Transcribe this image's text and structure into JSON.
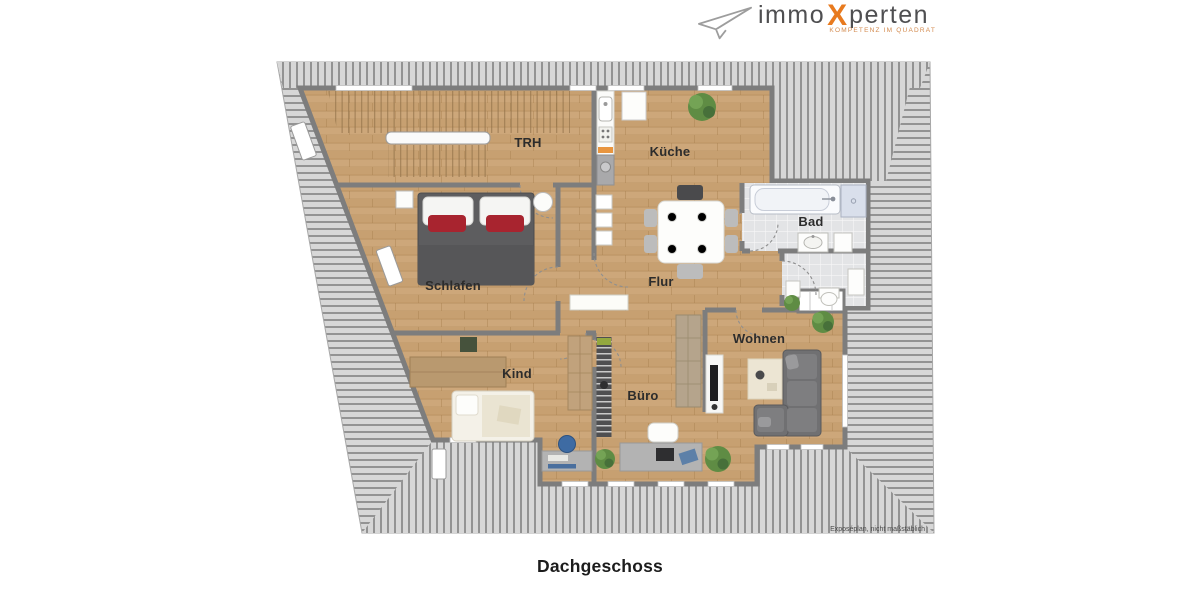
{
  "logo": {
    "brand_prefix": "immo",
    "brand_x": "X",
    "brand_suffix": "perten",
    "tagline": "KOMPETENZ IM QUADRAT"
  },
  "plan": {
    "title": "Dachgeschoss",
    "disclaimer": "Exposéplan, nicht maßstäblich",
    "rooms": [
      {
        "id": "trh",
        "label": "TRH"
      },
      {
        "id": "kueche",
        "label": "Küche"
      },
      {
        "id": "bad",
        "label": "Bad"
      },
      {
        "id": "schlafen",
        "label": "Schlafen"
      },
      {
        "id": "flur",
        "label": "Flur"
      },
      {
        "id": "kind",
        "label": "Kind"
      },
      {
        "id": "buero",
        "label": "Büro"
      },
      {
        "id": "wohnen",
        "label": "Wohnen"
      }
    ],
    "colors": {
      "wood": "#cda77a",
      "hatch_light": "#d7d7d7",
      "hatch_dark": "#939393",
      "wall": "#7d7d7d",
      "tile": "#e3e4e6",
      "bed_red": "#a8242f",
      "logo_orange": "#e87a1e"
    }
  }
}
